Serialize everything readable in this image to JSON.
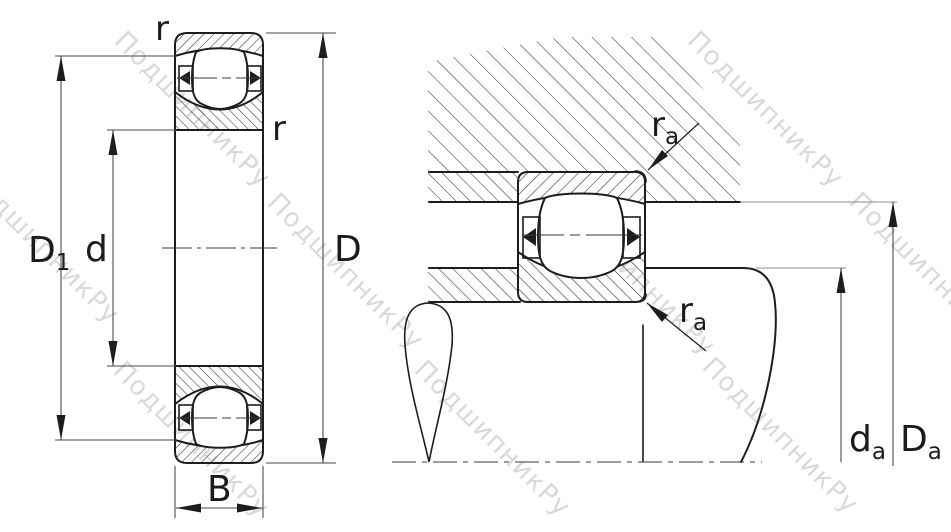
{
  "watermark": {
    "text": "ПодшипникРу",
    "color": "#d9d9d9"
  },
  "colors": {
    "background": "#ffffff",
    "line": "#1d1d1d",
    "dimension": "#4a4a4a",
    "label": "#1b1b1b"
  },
  "left_view": {
    "name": "bearing cross-section",
    "labels": {
      "rim_diameter": {
        "main": "D",
        "sub": "1"
      },
      "bore_diameter": {
        "main": "d",
        "sub": ""
      },
      "outside_diameter": {
        "main": "D",
        "sub": ""
      },
      "width": {
        "main": "B",
        "sub": ""
      },
      "corner_radius_top": {
        "main": "r",
        "sub": ""
      },
      "corner_radius_side": {
        "main": "r",
        "sub": ""
      }
    }
  },
  "right_view": {
    "name": "mounted bearing with abutment dimensions",
    "labels": {
      "housing_fillet_radius": {
        "main": "r",
        "sub": "a"
      },
      "shaft_fillet_radius": {
        "main": "r",
        "sub": "a"
      },
      "shaft_shoulder_diameter": {
        "main": "d",
        "sub": "a"
      },
      "housing_shoulder_diameter": {
        "main": "D",
        "sub": "a"
      }
    }
  }
}
